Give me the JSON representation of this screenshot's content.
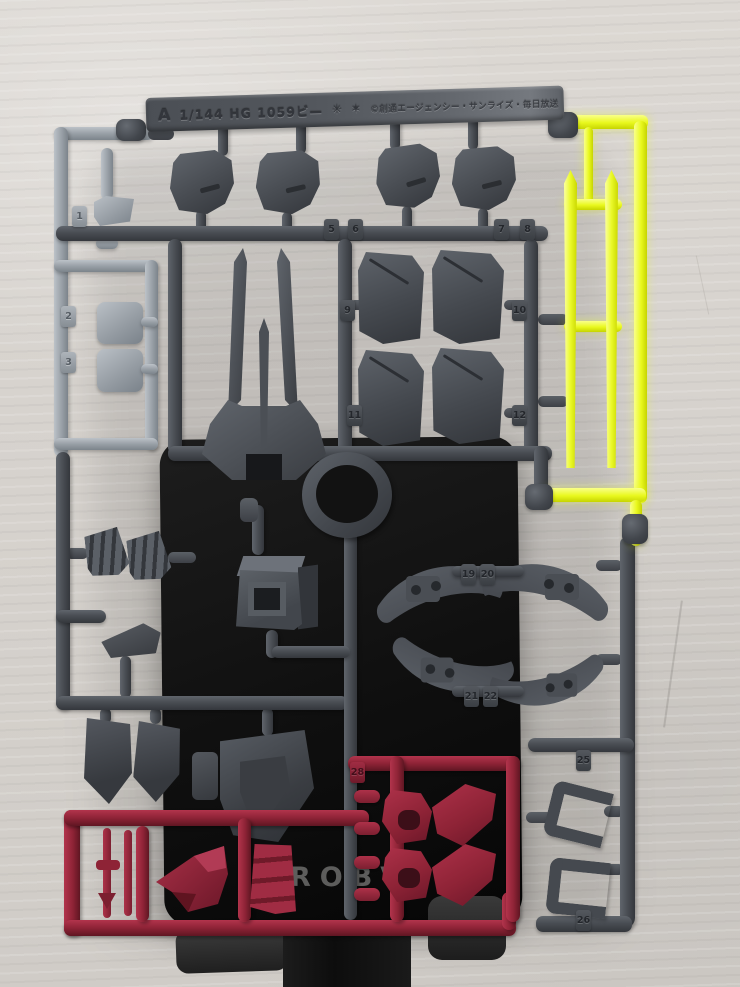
{
  "runner_label": {
    "letter": "A",
    "scale_text": "1/144 HG 1059ビ—",
    "mold_mark_1": "✳",
    "mold_mark_2": "✶",
    "copyright": "©創通エージェンシー・サンライズ・毎日放送"
  },
  "background_text": {
    "stand_text": "ROBV"
  },
  "part_tags": [
    {
      "n": "1",
      "x": 72,
      "y": 206,
      "c": "l"
    },
    {
      "n": "2",
      "x": 61,
      "y": 306,
      "c": "l"
    },
    {
      "n": "3",
      "x": 61,
      "y": 352,
      "c": "l"
    },
    {
      "n": "5",
      "x": 324,
      "y": 219,
      "c": "d"
    },
    {
      "n": "6",
      "x": 348,
      "y": 219,
      "c": "d"
    },
    {
      "n": "7",
      "x": 494,
      "y": 219,
      "c": "d"
    },
    {
      "n": "8",
      "x": 520,
      "y": 219,
      "c": "d"
    },
    {
      "n": "9",
      "x": 340,
      "y": 300,
      "c": "d"
    },
    {
      "n": "10",
      "x": 512,
      "y": 300,
      "c": "d"
    },
    {
      "n": "11",
      "x": 347,
      "y": 405,
      "c": "d"
    },
    {
      "n": "12",
      "x": 512,
      "y": 405,
      "c": "d"
    },
    {
      "n": "19",
      "x": 461,
      "y": 564,
      "c": "d"
    },
    {
      "n": "20",
      "x": 480,
      "y": 564,
      "c": "d"
    },
    {
      "n": "21",
      "x": 464,
      "y": 686,
      "c": "d"
    },
    {
      "n": "22",
      "x": 483,
      "y": 686,
      "c": "d"
    },
    {
      "n": "25",
      "x": 576,
      "y": 750,
      "c": "d"
    },
    {
      "n": "26",
      "x": 576,
      "y": 910,
      "c": "d"
    },
    {
      "n": "28",
      "x": 350,
      "y": 762,
      "c": "r"
    }
  ],
  "colors": {
    "wall": "#d8d4cf",
    "runner_dark": "#4a4e54",
    "runner_light": "#9aa1a8",
    "runner_yellow": "#e9f81e",
    "runner_red": "#8e2336",
    "backdrop_black": "#121212",
    "clamp": "#2b2b2b"
  }
}
